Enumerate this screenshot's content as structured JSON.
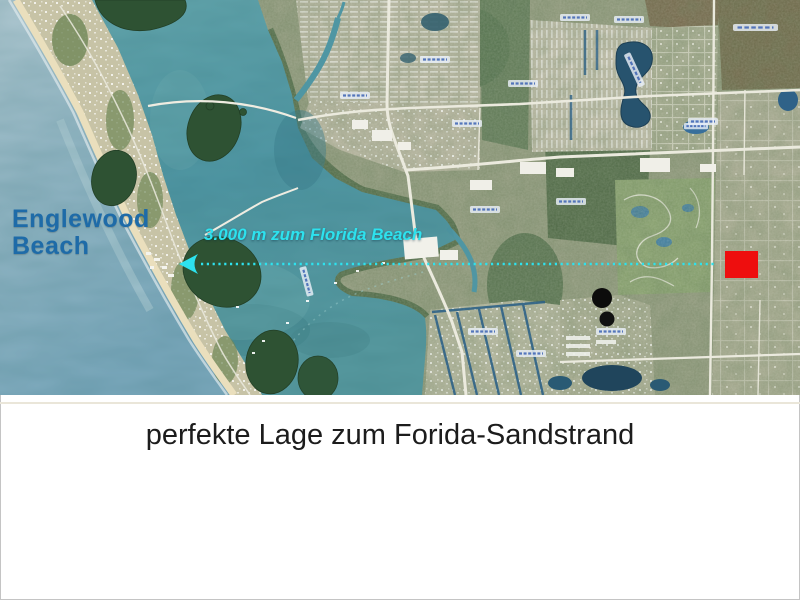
{
  "slide": {
    "caption": "perfekte Lage zum Forida-Sandstrand",
    "caption_color": "#1c1c1c",
    "background_color": "#ffffff"
  },
  "map": {
    "place_label": "Englewood Beach",
    "place_label_lines": [
      "Englewood",
      "Beach"
    ],
    "place_label_color": "#1e6ba8",
    "distance_label": "3.000 m zum Florida Beach",
    "annotation_color": "#2de2ee",
    "marker_color": "#ee0e0e",
    "bay_water_color": "#4f96a3",
    "ocean_water_color": "#9cbecb"
  }
}
